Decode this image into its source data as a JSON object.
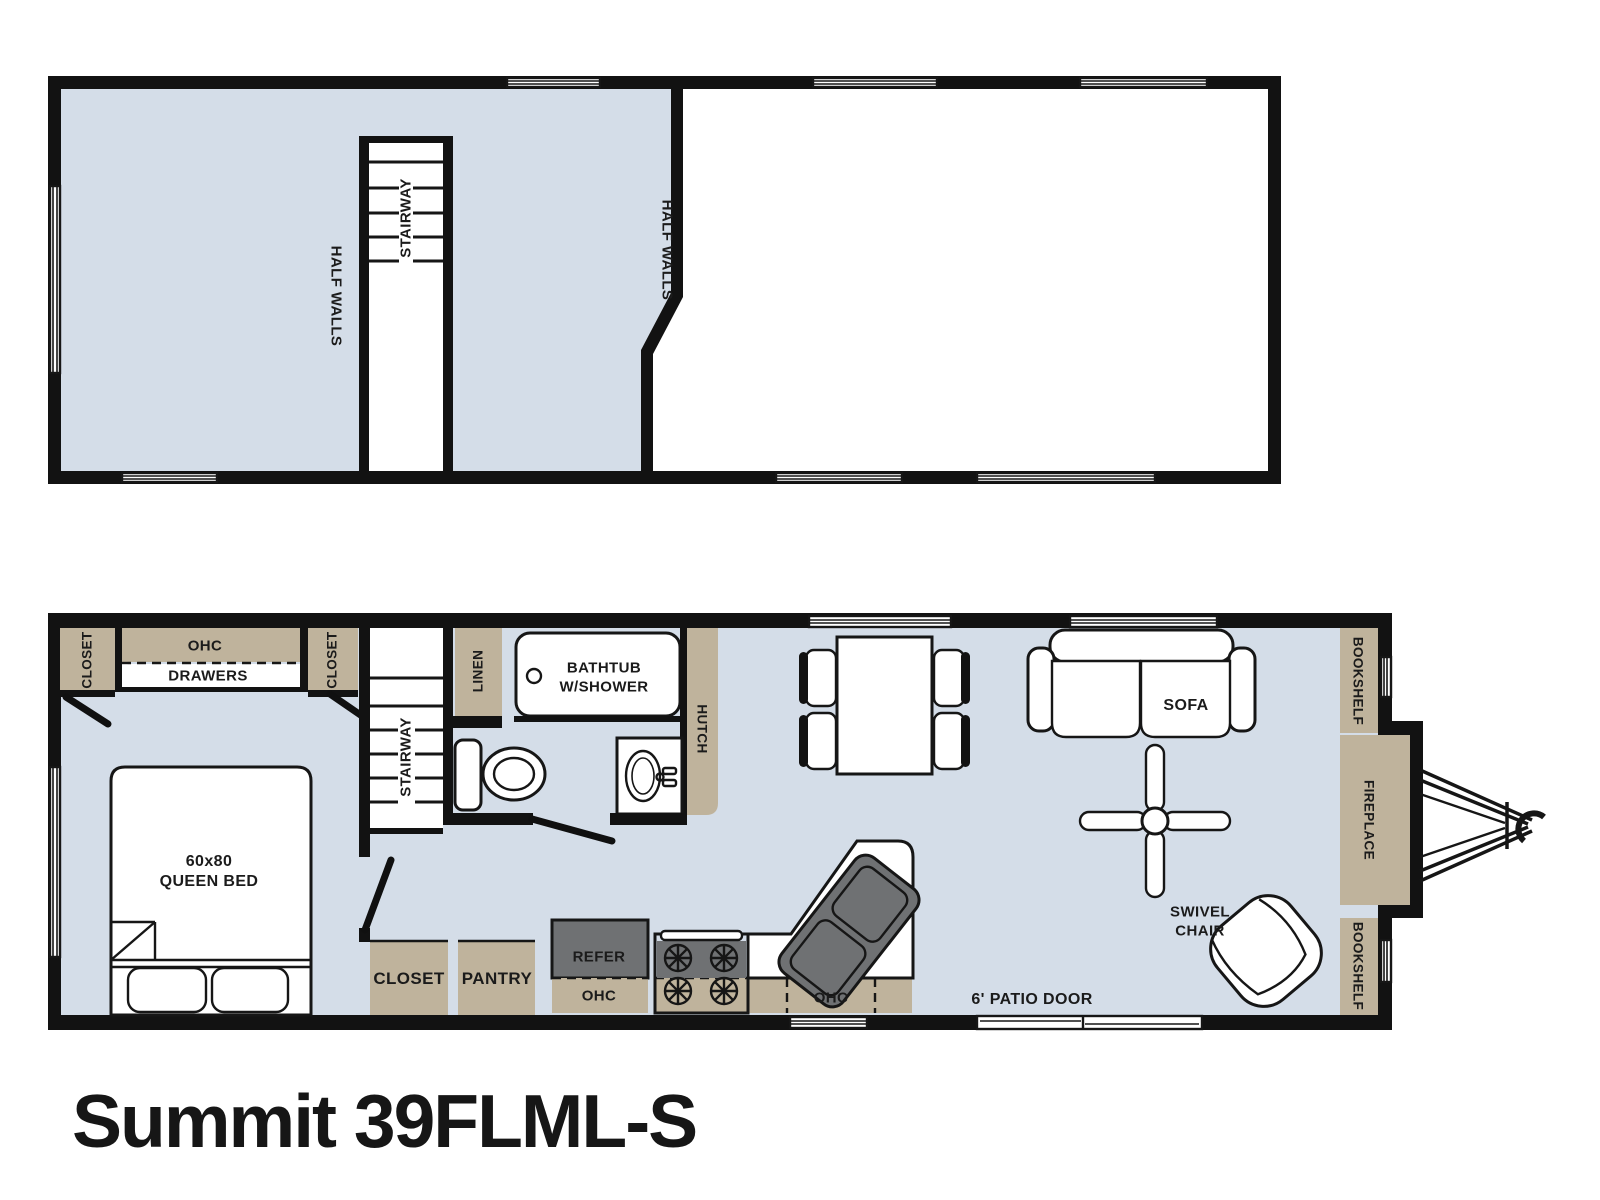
{
  "title": "Summit 39FLML-S",
  "colors": {
    "floor": "#d4dde8",
    "cabinet": "#bfb39c",
    "appliance": "#6f7173",
    "wall": "#121212"
  },
  "upper_floor": {
    "stairway": "STAIRWAY",
    "half_walls_left": "HALF WALLS",
    "half_walls_right": "HALF WALLS"
  },
  "main_floor": {
    "bedroom": {
      "closet_left": "CLOSET",
      "ohc": "OHC",
      "drawers": "DRAWERS",
      "closet_right": "CLOSET",
      "bed_line1": "60x80",
      "bed_line2": "QUEEN BED"
    },
    "stairway": "STAIRWAY",
    "bathroom": {
      "linen": "LINEN",
      "tub_line1": "BATHTUB",
      "tub_line2": "W/SHOWER"
    },
    "kitchen": {
      "closet": "CLOSET",
      "pantry": "PANTRY",
      "refer": "REFER",
      "ohc_left": "OHC",
      "ohc_right": "OHC",
      "hutch": "HUTCH"
    },
    "living": {
      "sofa": "SOFA",
      "swivel_line1": "SWIVEL",
      "swivel_line2": "CHAIR",
      "patio_door": "6' PATIO DOOR",
      "bookshelf_top": "BOOKSHELF",
      "fireplace": "FIREPLACE",
      "bookshelf_bottom": "BOOKSHELF"
    }
  }
}
